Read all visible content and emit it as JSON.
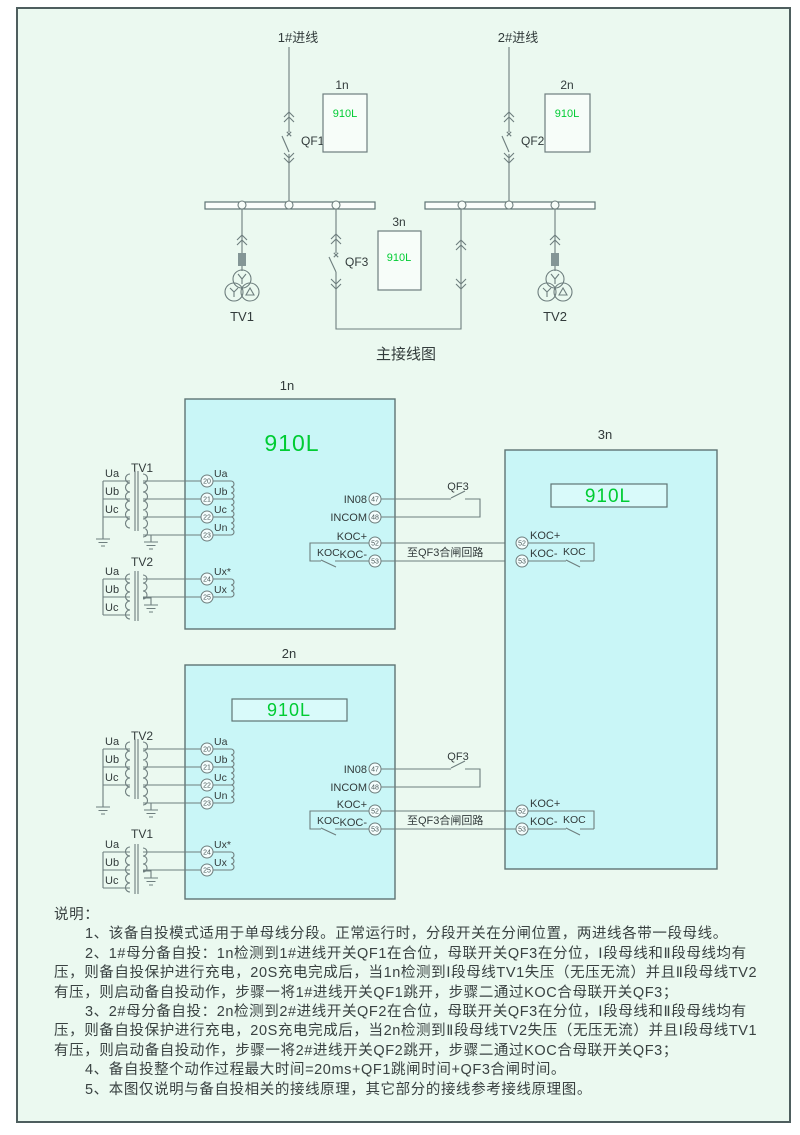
{
  "colors": {
    "background": "#ebf9f0",
    "frame_border": "#4e5e5e",
    "device_box": "#c9f6f7",
    "model_green": "#00cc33",
    "wire": "#6e7e7e"
  },
  "main": {
    "title": "主接线图",
    "feeder1": "1#进线",
    "feeder2": "2#进线",
    "qf1": "QF1",
    "qf2": "QF2",
    "qf3": "QF3",
    "tv1": "TV1",
    "tv2": "TV2",
    "n1": "1n",
    "n2": "2n",
    "n3": "3n",
    "model": "910L"
  },
  "dev1n": {
    "label": "1n",
    "model": "910L",
    "tv_top": {
      "name": "TV1",
      "p": [
        "Ua",
        "Ub",
        "Uc"
      ]
    },
    "tv_bottom": {
      "name": "TV2",
      "p": [
        "Ua",
        "Ub",
        "Uc"
      ]
    },
    "t": {
      "n20": "20",
      "n21": "21",
      "n22": "22",
      "n23": "23",
      "n24": "24",
      "n25": "25",
      "l20": "Ua",
      "l21": "Ub",
      "l22": "Uc",
      "l23": "Un",
      "l24": "Ux*",
      "l25": "Ux"
    },
    "io": {
      "in08": "IN08",
      "n47": "47",
      "incom": "INCOM",
      "n48": "48",
      "kocp": "KOC+",
      "n52": "52",
      "kocm": "KOC-",
      "n53": "53",
      "koc": "KOC",
      "qf3": "QF3",
      "note": "至QF3合闸回路"
    }
  },
  "dev2n": {
    "label": "2n",
    "model": "910L",
    "tv_top": {
      "name": "TV2",
      "p": [
        "Ua",
        "Ub",
        "Uc"
      ]
    },
    "tv_bottom": {
      "name": "TV1",
      "p": [
        "Ua",
        "Ub",
        "Uc"
      ]
    },
    "t": {
      "n20": "20",
      "n21": "21",
      "n22": "22",
      "n23": "23",
      "n24": "24",
      "n25": "25",
      "l20": "Ua",
      "l21": "Ub",
      "l22": "Uc",
      "l23": "Un",
      "l24": "Ux*",
      "l25": "Ux"
    },
    "io": {
      "in08": "IN08",
      "n47": "47",
      "incom": "INCOM",
      "n48": "48",
      "kocp": "KOC+",
      "n52": "52",
      "kocm": "KOC-",
      "n53": "53",
      "koc": "KOC",
      "qf3": "QF3",
      "note": "至QF3合闸回路"
    }
  },
  "dev3n": {
    "label": "3n",
    "model": "910L",
    "kocp": "KOC+",
    "n52": "52",
    "kocm": "KOC-",
    "n53": "53",
    "koc": "KOC"
  },
  "notes": {
    "heading": "说明：",
    "items": [
      "1、该备自投模式适用于单母线分段。正常运行时，分段开关在分闸位置，两进线各带一段母线。",
      "2、1#母分备自投：1n检测到1#进线开关QF1在合位，母联开关QF3在分位，Ⅰ段母线和Ⅱ段母线均有压，则备自投保护进行充电，20S充电完成后，当1n检测到Ⅰ段母线TV1失压（无压无流）并且Ⅱ段母线TV2有压，则启动备自投动作，步骤一将1#进线开关QF1跳开，步骤二通过KOC合母联开关QF3；",
      "3、2#母分备自投：2n检测到2#进线开关QF2在合位，母联开关QF3在分位，Ⅰ段母线和Ⅱ段母线均有压，则备自投保护进行充电，20S充电完成后，当2n检测到Ⅱ段母线TV2失压（无压无流）并且Ⅰ段母线TV1有压，则启动备自投动作，步骤一将2#进线开关QF2跳开，步骤二通过KOC合母联开关QF3；",
      "4、备自投整个动作过程最大时间=20ms+QF1跳闸时间+QF3合闸时间。",
      "5、本图仅说明与备自投相关的接线原理，其它部分的接线参考接线原理图。"
    ]
  }
}
